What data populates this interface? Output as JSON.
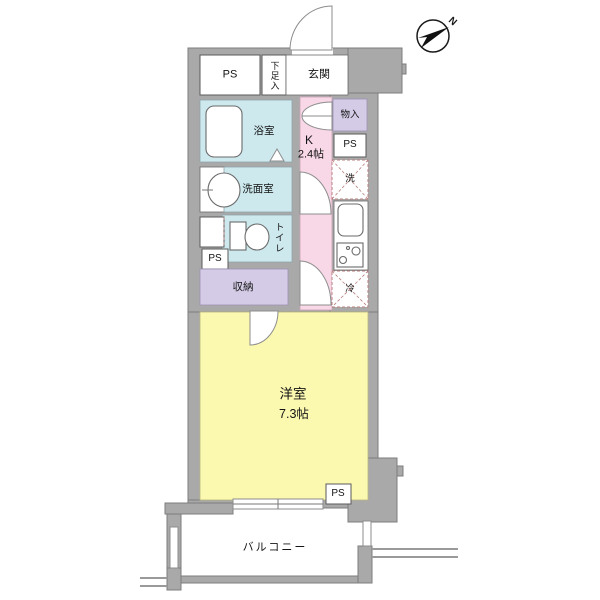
{
  "compass": {
    "north_label": "N"
  },
  "rooms": {
    "ps_top": "PS",
    "shoe_box": "下足入",
    "entrance": "玄関",
    "closet_upper": "物入",
    "ps_right": "PS",
    "washer": "洗",
    "kitchen": {
      "label": "K",
      "size": "2.4帖"
    },
    "bathroom": "浴室",
    "washroom": "洗面室",
    "toilet": "トイレ",
    "ps_left": "PS",
    "storage": "収納",
    "fridge": "冷",
    "western_room": {
      "label": "洋室",
      "size": "7.3帖"
    },
    "ps_bottom": "PS",
    "balcony": "バルコニー"
  },
  "colors": {
    "wall": "#a9a9a9",
    "wall_edge": "#7d7d7d",
    "water_blue": "#cde9ee",
    "kitchen_pink": "#f8d7e6",
    "closet_purple": "#d4cce6",
    "room_yellow": "#fbf8b0",
    "dash_red": "#b97f7f",
    "line_gray": "#9a9a9a"
  }
}
